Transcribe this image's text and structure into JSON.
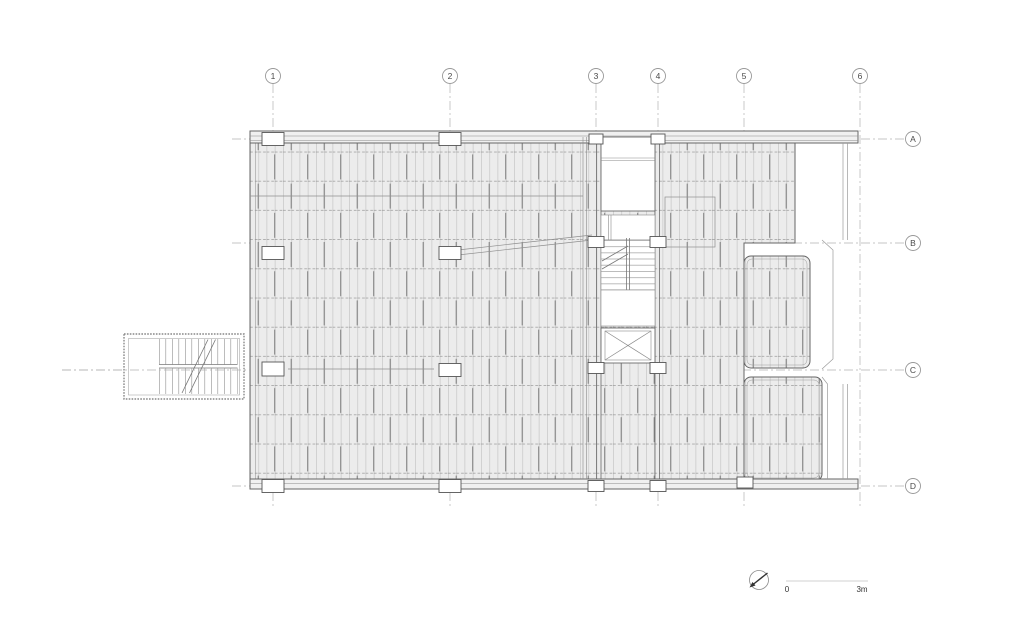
{
  "drawing": {
    "grid": {
      "columns": [
        "1",
        "2",
        "3",
        "4",
        "5",
        "6"
      ],
      "rows": [
        "A",
        "B",
        "C",
        "D"
      ]
    },
    "scale_bar": {
      "start": "0",
      "end": "3m"
    },
    "icons": {
      "north_arrow": "compass-circle-with-needle"
    },
    "colors": {
      "background": "#ffffff",
      "hatch_fill": "#ececec",
      "joist_line": "#bcbcbc",
      "dark_joist_line": "#7d7d7d",
      "beam_dash_line": "#9c9c9c",
      "outline": "#666666",
      "grid_line": "#b3b3b3",
      "bubble_stroke": "#999999",
      "text": "#4a4a4a"
    }
  }
}
